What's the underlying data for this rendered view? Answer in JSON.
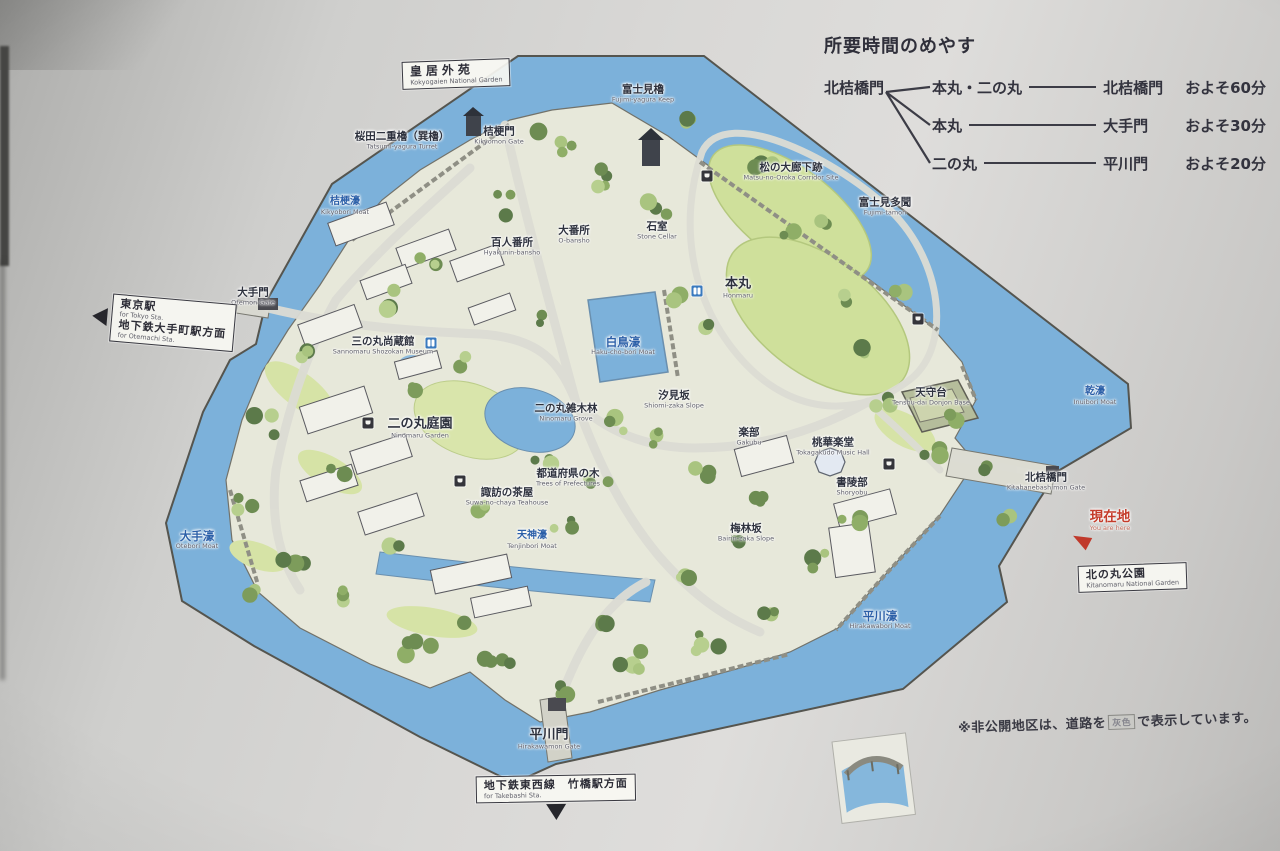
{
  "legend": {
    "title": "所要時間のめやす",
    "start": "北桔橋門",
    "rows": [
      {
        "via": "本丸・二の丸",
        "dest": "北桔橋門",
        "time": "およそ60分"
      },
      {
        "via": "本丸",
        "dest": "大手門",
        "time": "およそ30分"
      },
      {
        "via": "二の丸",
        "dest": "平川門",
        "time": "およそ20分"
      }
    ]
  },
  "note": {
    "prefix": "※非公開地区は、道路を",
    "highlight": "灰色",
    "suffix": "で表示しています。"
  },
  "signs": [
    {
      "name": "kokyogaien-sign",
      "x": 402,
      "y": 60,
      "rot": -2,
      "arrow": null,
      "spaced": true,
      "lines": [
        {
          "ja": "皇居外苑",
          "en": "Kokyogaien National Garden"
        }
      ]
    },
    {
      "name": "tokyo-station-sign",
      "x": 92,
      "y": 298,
      "rot": 5,
      "arrow": "left",
      "spaced": false,
      "lines": [
        {
          "ja": "東京駅",
          "en": "for Tokyo Sta."
        },
        {
          "ja": "地下鉄大手町駅方面",
          "en": "for Otemachi Sta."
        }
      ]
    },
    {
      "name": "kitanomaru-sign",
      "x": 1078,
      "y": 564,
      "rot": -2,
      "arrow": null,
      "spaced": false,
      "lines": [
        {
          "ja": "北の丸公園",
          "en": "Kitanomaru National Garden"
        }
      ]
    },
    {
      "name": "takebashi-sign",
      "x": 476,
      "y": 775,
      "rot": -1,
      "arrow": "down",
      "spaced": false,
      "lines": [
        {
          "ja": "地下鉄東西線　竹橋駅方面",
          "en": "for Takebashi Sta."
        }
      ]
    }
  ],
  "map_labels": [
    {
      "name": "fujimi-yagura",
      "ja": "富士見櫓",
      "en": "Fujimi-yagura Keep",
      "x": 643,
      "y": 94,
      "cls": "place-s"
    },
    {
      "name": "sakurada-tatsumi-yagura",
      "ja": "桜田二重櫓（巽櫓）",
      "en": "Tatsumi-yagura Turret",
      "x": 402,
      "y": 141,
      "cls": "place-s"
    },
    {
      "name": "kikyomon-gate",
      "ja": "桔梗門",
      "en": "Kikyomon Gate",
      "x": 499,
      "y": 136,
      "cls": "place-s"
    },
    {
      "name": "kikyobori-moat",
      "ja": "桔梗濠",
      "en": "Kikyobori Moat",
      "x": 345,
      "y": 206,
      "cls": "moat-s"
    },
    {
      "name": "otemon-gate",
      "ja": "大手門",
      "en": "Otemon Gate",
      "x": 253,
      "y": 297,
      "cls": "place-s"
    },
    {
      "name": "sannomaru-shozokan",
      "ja": "三の丸尚蔵館",
      "en": "Sannomaru Shozokan Museum",
      "x": 383,
      "y": 346,
      "cls": "place-s"
    },
    {
      "name": "hyakunin-bansho",
      "ja": "百人番所",
      "en": "Hyakunin-bansho",
      "x": 512,
      "y": 247,
      "cls": "place-s"
    },
    {
      "name": "o-bansho",
      "ja": "大番所",
      "en": "O-bansho",
      "x": 574,
      "y": 235,
      "cls": "place-s"
    },
    {
      "name": "matsuno-oroka-site",
      "ja": "松の大廊下跡",
      "en": "Matsu-no-Oroka Corridor Site",
      "x": 791,
      "y": 172,
      "cls": "place-s"
    },
    {
      "name": "fujimi-tamon",
      "ja": "富士見多聞",
      "en": "Fujimi-tamon",
      "x": 885,
      "y": 207,
      "cls": "place-s"
    },
    {
      "name": "honmaru",
      "ja": "本丸",
      "en": "Honmaru",
      "x": 738,
      "y": 288,
      "cls": "place"
    },
    {
      "name": "ishimuro",
      "ja": "石室",
      "en": "Stone Cellar",
      "x": 657,
      "y": 231,
      "cls": "place-s"
    },
    {
      "name": "hakuchobori-moat",
      "ja": "白鳥濠",
      "en": "Haku-cho-bori Moat",
      "x": 623,
      "y": 346,
      "cls": "moat"
    },
    {
      "name": "shiomizaka-slope",
      "ja": "汐見坂",
      "en": "Shiomi-zaka Slope",
      "x": 674,
      "y": 400,
      "cls": "place-s"
    },
    {
      "name": "ninomaru-grove",
      "ja": "二の丸雑木林",
      "en": "Ninomaru Grove",
      "x": 566,
      "y": 413,
      "cls": "place-s"
    },
    {
      "name": "ninomaru-garden",
      "ja": "二の丸庭園",
      "en": "Ninomaru Garden",
      "x": 420,
      "y": 428,
      "cls": "place"
    },
    {
      "name": "gakubu",
      "ja": "楽部",
      "en": "Gakubu",
      "x": 749,
      "y": 437,
      "cls": "place-s"
    },
    {
      "name": "tokagakudo",
      "ja": "桃華楽堂",
      "en": "Tokagakudo Music Hall",
      "x": 833,
      "y": 447,
      "cls": "place-s"
    },
    {
      "name": "tenshudai",
      "ja": "天守台",
      "en": "Tenshu-dai Donjon Base",
      "x": 931,
      "y": 397,
      "cls": "place-s"
    },
    {
      "name": "shoryobu",
      "ja": "書陵部",
      "en": "Shoryobu",
      "x": 852,
      "y": 487,
      "cls": "place-s"
    },
    {
      "name": "bairinzaka-slope",
      "ja": "梅林坂",
      "en": "Bairin-zaka Slope",
      "x": 746,
      "y": 533,
      "cls": "place-s"
    },
    {
      "name": "tenjinbori-moat",
      "ja": "天神濠",
      "en": "Tenjinbori Moat",
      "x": 532,
      "y": 540,
      "cls": "moat-s"
    },
    {
      "name": "suwa-no-chaya",
      "ja": "諏訪の茶屋",
      "en": "Suwa-no-chaya Teahouse",
      "x": 507,
      "y": 497,
      "cls": "place-s"
    },
    {
      "name": "todofuken-no-ki",
      "ja": "都道府県の木",
      "en": "Trees of Prefectures",
      "x": 568,
      "y": 478,
      "cls": "place-s"
    },
    {
      "name": "otebori-moat",
      "ja": "大手濠",
      "en": "Otebori Moat",
      "x": 197,
      "y": 540,
      "cls": "moat"
    },
    {
      "name": "inuibori-moat",
      "ja": "乾濠",
      "en": "Inuibori Moat",
      "x": 1095,
      "y": 396,
      "cls": "moat-s"
    },
    {
      "name": "hirakawabori-moat",
      "ja": "平川濠",
      "en": "Hirakawabori Moat",
      "x": 880,
      "y": 620,
      "cls": "moat"
    },
    {
      "name": "kitahanebashimon-gate",
      "ja": "北桔橋門",
      "en": "Kitahanebashimon Gate",
      "x": 1046,
      "y": 482,
      "cls": "place-s"
    },
    {
      "name": "you-are-here",
      "ja": "現在地",
      "en": "You are here",
      "x": 1110,
      "y": 521,
      "cls": "red"
    },
    {
      "name": "hirakawamon-gate",
      "ja": "平川門",
      "en": "Hirakawamon Gate",
      "x": 549,
      "y": 739,
      "cls": "place"
    }
  ],
  "poi_icons": [
    {
      "name": "toilet-icon",
      "type": "toilet",
      "x": 431,
      "y": 343
    },
    {
      "name": "toilet-icon",
      "type": "toilet",
      "x": 697,
      "y": 291
    },
    {
      "name": "resthouse-icon",
      "type": "facility",
      "x": 707,
      "y": 176
    },
    {
      "name": "resthouse-icon",
      "type": "facility",
      "x": 368,
      "y": 423
    },
    {
      "name": "resthouse-icon",
      "type": "facility",
      "x": 460,
      "y": 481
    },
    {
      "name": "marker-icon",
      "type": "facility",
      "x": 889,
      "y": 464
    },
    {
      "name": "marker-icon",
      "type": "facility",
      "x": 918,
      "y": 319
    }
  ],
  "colors": {
    "moat_blue": "#7cb1da",
    "land": "#e7e8da",
    "lawn": "#cfe09b",
    "sign_background": "#d5d5d3",
    "accent_red": "#c0392b",
    "moat_label_blue": "#2b5fa8",
    "ink": "#32323c"
  }
}
